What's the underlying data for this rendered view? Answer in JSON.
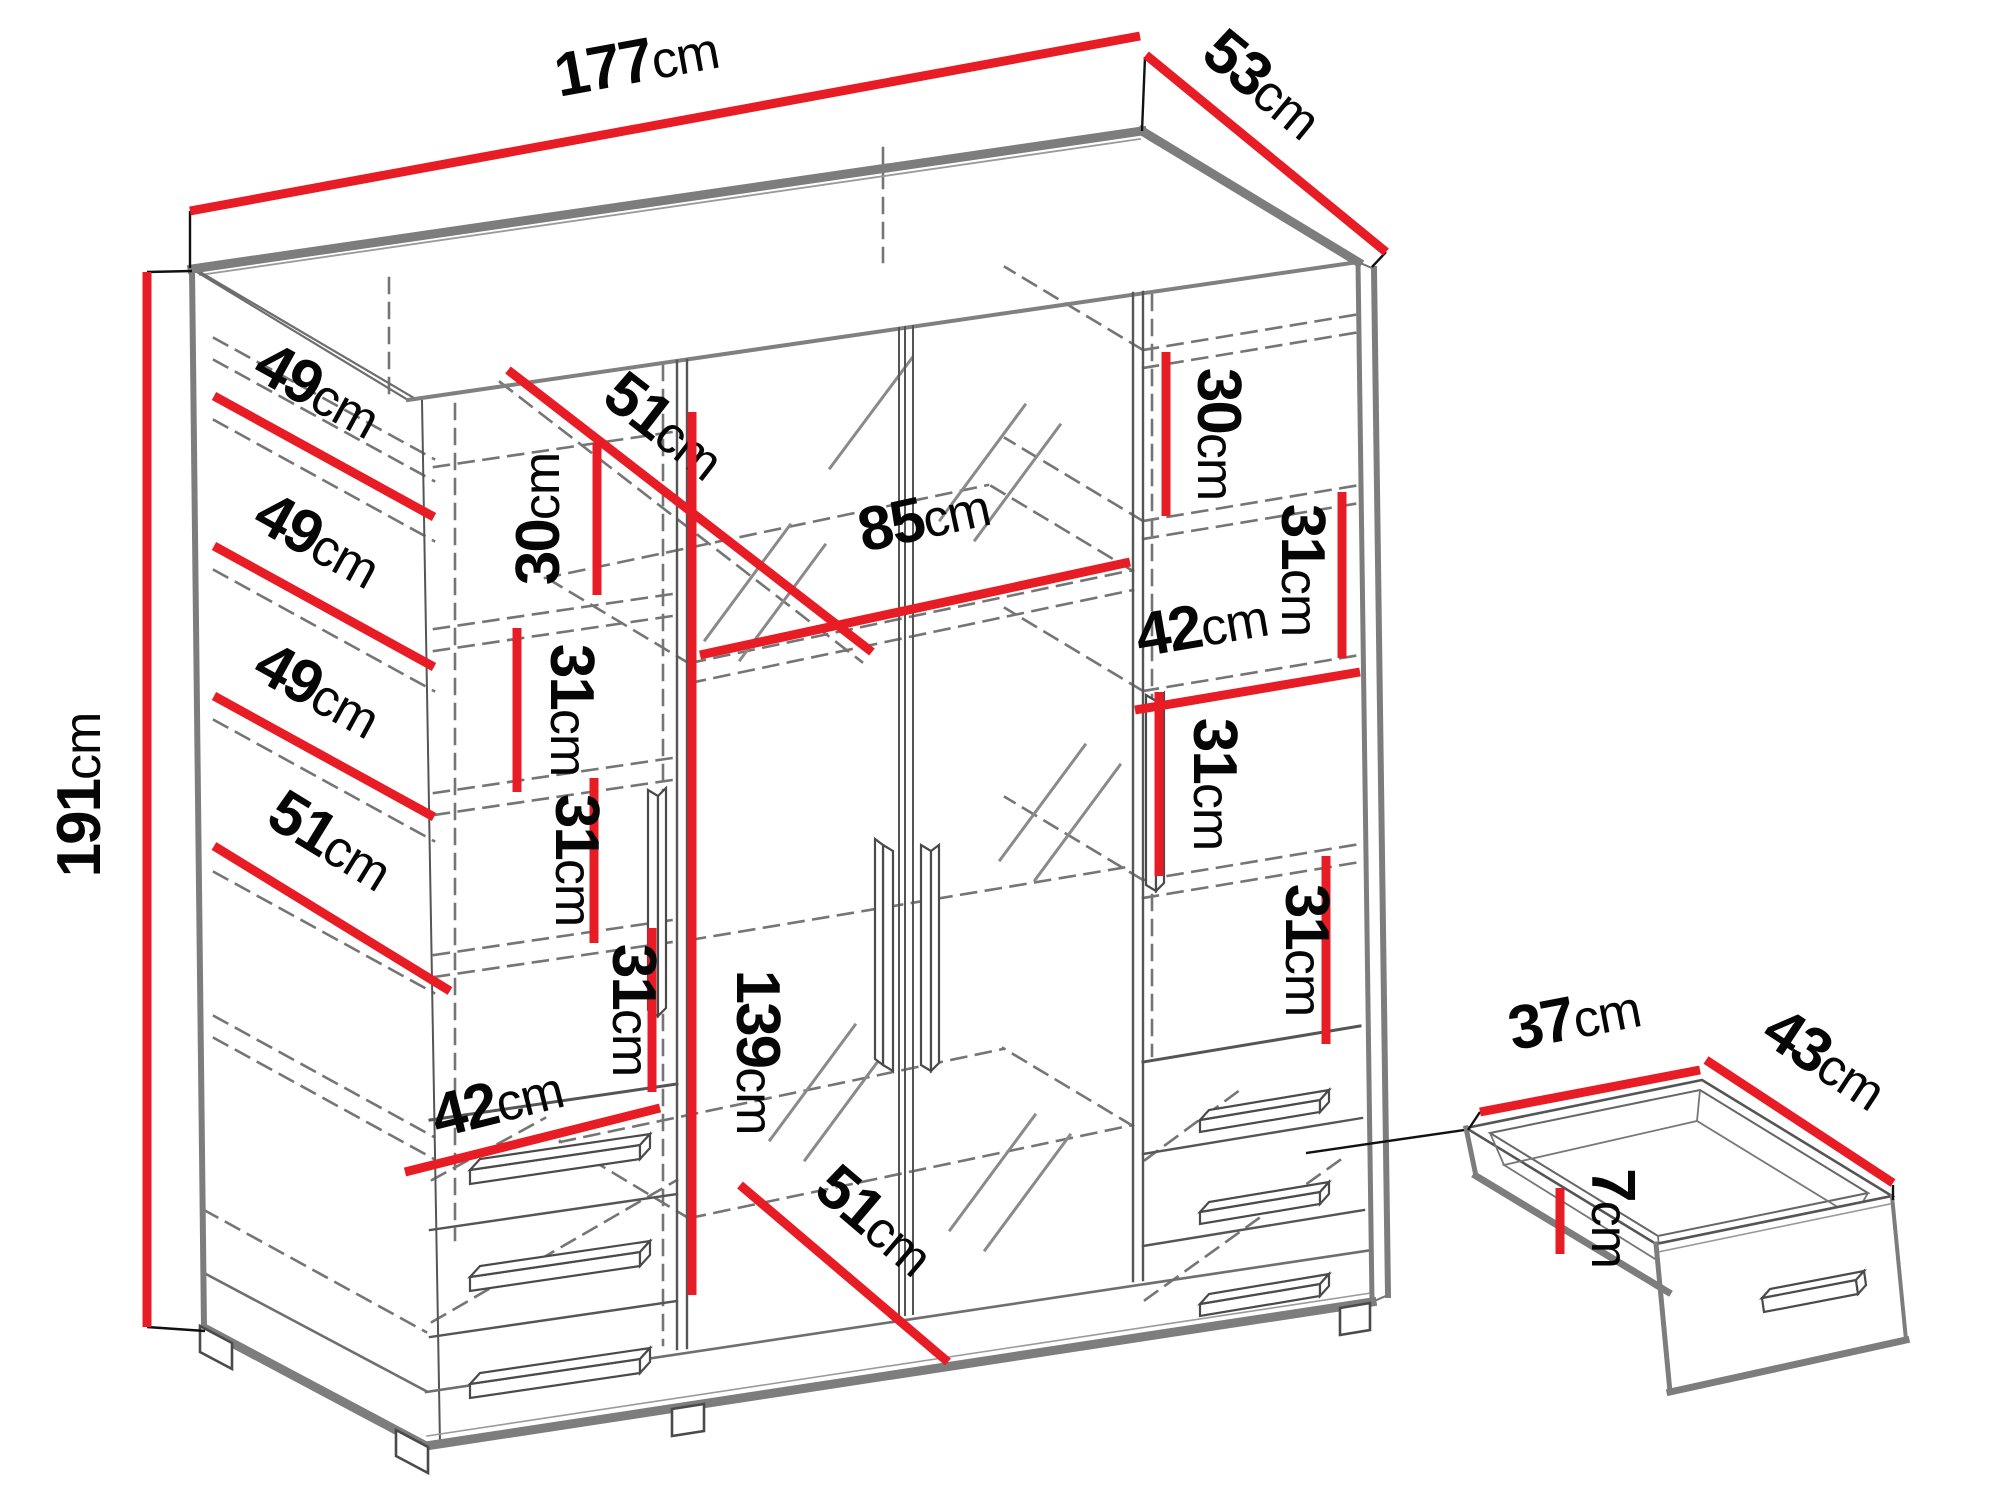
{
  "diagram": {
    "type": "furniture-dimension-diagram",
    "subject": "four-door mirrored wardrobe with shelves and drawers, plus pull-out drawer detail",
    "unit": "cm",
    "colors": {
      "dimension_red": "#e81c24",
      "outline_gray": "#7d7d7d",
      "line_dark": "#4a4a4a",
      "dashed_gray": "#757575",
      "label_black": "#060606",
      "background": "#ffffff"
    },
    "dimensions": [
      {
        "id": "overall-width-177",
        "number": "177",
        "unit": "cm",
        "line": {
          "x1": 190,
          "y1": 211,
          "x2": 1140,
          "y2": 36
        },
        "label": {
          "x": 640,
          "y": 82,
          "rotate": -10.4
        }
      },
      {
        "id": "overall-depth-53",
        "number": "53",
        "unit": "cm",
        "line": {
          "x1": 1146,
          "y1": 55,
          "x2": 1386,
          "y2": 252
        },
        "label": {
          "x": 1250,
          "y": 100,
          "rotate": 39.4
        }
      },
      {
        "id": "overall-height-191",
        "number": "191",
        "unit": "cm",
        "line": {
          "x1": 147,
          "y1": 272,
          "x2": 147,
          "y2": 1327
        },
        "label": {
          "x": 100,
          "y": 795,
          "rotate": -90
        }
      },
      {
        "id": "shelf-depth-49-a",
        "number": "49",
        "unit": "cm",
        "line": {
          "x1": 214,
          "y1": 396,
          "x2": 434,
          "y2": 517
        },
        "label": {
          "x": 308,
          "y": 408,
          "rotate": 28.8
        }
      },
      {
        "id": "shelf-depth-49-b",
        "number": "49",
        "unit": "cm",
        "line": {
          "x1": 214,
          "y1": 546,
          "x2": 434,
          "y2": 667
        },
        "label": {
          "x": 308,
          "y": 558,
          "rotate": 28.8
        }
      },
      {
        "id": "shelf-depth-49-c",
        "number": "49",
        "unit": "cm",
        "line": {
          "x1": 214,
          "y1": 696,
          "x2": 434,
          "y2": 817
        },
        "label": {
          "x": 308,
          "y": 708,
          "rotate": 28.8
        }
      },
      {
        "id": "shelf-depth-51-left",
        "number": "51",
        "unit": "cm",
        "line": {
          "x1": 214,
          "y1": 846,
          "x2": 450,
          "y2": 991
        },
        "label": {
          "x": 320,
          "y": 858,
          "rotate": 31.6
        }
      },
      {
        "id": "gap-30-left",
        "number": "30",
        "unit": "cm",
        "line": {
          "x1": 597,
          "y1": 443,
          "x2": 597,
          "y2": 595
        },
        "label": {
          "x": 559,
          "y": 519,
          "rotate": -90
        }
      },
      {
        "id": "gap-31-left-1",
        "number": "31",
        "unit": "cm",
        "line": {
          "x1": 517,
          "y1": 628,
          "x2": 517,
          "y2": 792
        },
        "label": {
          "x": 551,
          "y": 710,
          "rotate": 90
        }
      },
      {
        "id": "gap-31-left-2",
        "number": "31",
        "unit": "cm",
        "line": {
          "x1": 594,
          "y1": 778,
          "x2": 594,
          "y2": 943
        },
        "label": {
          "x": 556,
          "y": 860,
          "rotate": 90
        }
      },
      {
        "id": "gap-31-left-3",
        "number": "31",
        "unit": "cm",
        "line": {
          "x1": 652,
          "y1": 928,
          "x2": 652,
          "y2": 1092
        },
        "label": {
          "x": 613,
          "y": 1010,
          "rotate": 90
        }
      },
      {
        "id": "interior-depth-51-top",
        "number": "51",
        "unit": "cm",
        "line": {
          "x1": 508,
          "y1": 370,
          "x2": 872,
          "y2": 652
        },
        "label": {
          "x": 652,
          "y": 442,
          "rotate": 37.8
        }
      },
      {
        "id": "interior-width-85",
        "number": "85",
        "unit": "cm",
        "line": {
          "x1": 700,
          "y1": 655,
          "x2": 1130,
          "y2": 562
        },
        "label": {
          "x": 928,
          "y": 538,
          "rotate": -12.2
        }
      },
      {
        "id": "interior-height-139",
        "number": "139",
        "unit": "cm",
        "line": {
          "x1": 692,
          "y1": 412,
          "x2": 692,
          "y2": 1295
        },
        "label": {
          "x": 737,
          "y": 1052,
          "rotate": 90
        }
      },
      {
        "id": "gap-30-right",
        "number": "30",
        "unit": "cm",
        "line": {
          "x1": 1166,
          "y1": 352,
          "x2": 1166,
          "y2": 516
        },
        "label": {
          "x": 1198,
          "y": 434,
          "rotate": 90
        }
      },
      {
        "id": "gap-31-right-1",
        "number": "31",
        "unit": "cm",
        "line": {
          "x1": 1342,
          "y1": 492,
          "x2": 1342,
          "y2": 658
        },
        "label": {
          "x": 1282,
          "y": 570,
          "rotate": 90
        }
      },
      {
        "id": "shelf-width-42-right",
        "number": "42",
        "unit": "cm",
        "line": {
          "x1": 1135,
          "y1": 710,
          "x2": 1360,
          "y2": 672
        },
        "label": {
          "x": 1205,
          "y": 646,
          "rotate": -9.6
        }
      },
      {
        "id": "gap-31-right-2",
        "number": "31",
        "unit": "cm",
        "line": {
          "x1": 1159,
          "y1": 692,
          "x2": 1159,
          "y2": 876
        },
        "label": {
          "x": 1194,
          "y": 784,
          "rotate": 90
        }
      },
      {
        "id": "gap-31-right-3",
        "number": "31",
        "unit": "cm",
        "line": {
          "x1": 1326,
          "y1": 856,
          "x2": 1326,
          "y2": 1044
        },
        "label": {
          "x": 1286,
          "y": 950,
          "rotate": 90
        }
      },
      {
        "id": "shelf-width-42-left",
        "number": "42",
        "unit": "cm",
        "line": {
          "x1": 405,
          "y1": 1172,
          "x2": 660,
          "y2": 1108
        },
        "label": {
          "x": 502,
          "y": 1122,
          "rotate": -14.1
        }
      },
      {
        "id": "interior-depth-51-bottom",
        "number": "51",
        "unit": "cm",
        "line": {
          "x1": 740,
          "y1": 1185,
          "x2": 948,
          "y2": 1362
        },
        "label": {
          "x": 862,
          "y": 1236,
          "rotate": 40.4
        }
      },
      {
        "id": "drawer-width-37",
        "number": "37",
        "unit": "cm",
        "line": {
          "x1": 1480,
          "y1": 1112,
          "x2": 1700,
          "y2": 1070
        },
        "label": {
          "x": 1578,
          "y": 1038,
          "rotate": -10.8
        }
      },
      {
        "id": "drawer-depth-43",
        "number": "43",
        "unit": "cm",
        "line": {
          "x1": 1706,
          "y1": 1060,
          "x2": 1893,
          "y2": 1183
        },
        "label": {
          "x": 1814,
          "y": 1076,
          "rotate": 33.3
        }
      },
      {
        "id": "drawer-height-7",
        "number": "7",
        "unit": "cm",
        "line": {
          "x1": 1560,
          "y1": 1188,
          "x2": 1560,
          "y2": 1254
        },
        "label": {
          "x": 1592,
          "y": 1218,
          "rotate": 90
        }
      }
    ],
    "connectors": [
      {
        "x1": 190,
        "y1": 211,
        "x2": 190,
        "y2": 268
      },
      {
        "x1": 1145,
        "y1": 57,
        "x2": 1142,
        "y2": 131
      },
      {
        "x1": 1386,
        "y1": 252,
        "x2": 1372,
        "y2": 267
      },
      {
        "x1": 147,
        "y1": 272,
        "x2": 192,
        "y2": 271
      },
      {
        "x1": 147,
        "y1": 1327,
        "x2": 205,
        "y2": 1331
      },
      {
        "x1": 1306,
        "y1": 1153,
        "x2": 1464,
        "y2": 1130
      },
      {
        "x1": 1480,
        "y1": 1112,
        "x2": 1468,
        "y2": 1130
      },
      {
        "x1": 1893,
        "y1": 1185,
        "x2": 1893,
        "y2": 1200
      }
    ]
  }
}
